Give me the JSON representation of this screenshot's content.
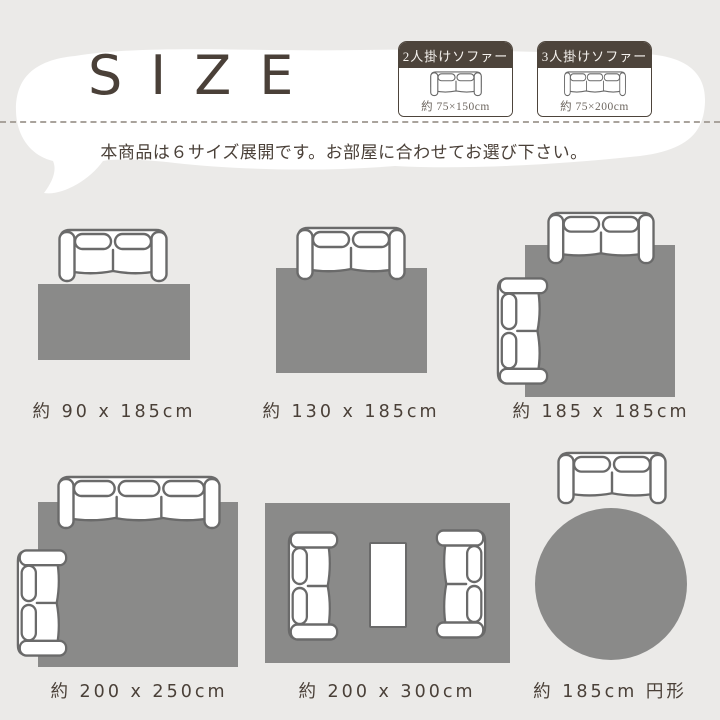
{
  "colors": {
    "background": "#ebeae8",
    "bubble": "#ffffff",
    "text_dark": "#4a4038",
    "rug_gray": "#8a8a89",
    "header_brown": "#4d443b",
    "legend_size_text": "#6d665f",
    "sofa_outline": "#6a6a6a",
    "dash": "#a9a39c"
  },
  "header": {
    "title": "SIZE",
    "subtitle": "本商品は６サイズ展開です。お部屋に合わせてお選び下さい。"
  },
  "legend": {
    "items": [
      {
        "label": "2人掛けソファー",
        "size": "約 75×150cm",
        "icon": "sofa-2seat-top-view"
      },
      {
        "label": "3人掛けソファー",
        "size": "約 75×200cm",
        "icon": "sofa-3seat-top-view"
      }
    ]
  },
  "layouts": [
    {
      "label": "約 90 x 185cm",
      "shape": "rectangle",
      "furniture": [
        "sofa-2seat-above-rug"
      ]
    },
    {
      "label": "約 130 x 185cm",
      "shape": "rectangle",
      "furniture": [
        "sofa-2seat-on-top-edge"
      ]
    },
    {
      "label": "約 185 x 185cm",
      "shape": "square",
      "furniture": [
        "sofa-2seat-on-top-edge",
        "sofa-2seat-on-left-edge"
      ]
    },
    {
      "label": "約 200 x 250cm",
      "shape": "rectangle",
      "furniture": [
        "sofa-3seat-on-top-edge",
        "sofa-2seat-on-left-edge"
      ]
    },
    {
      "label": "約 200 x 300cm",
      "shape": "rectangle",
      "furniture": [
        "sofa-2seat-facing-right",
        "table",
        "sofa-2seat-facing-left"
      ]
    },
    {
      "label": "約 185cm 円形",
      "shape": "circle",
      "furniture": [
        "sofa-2seat-above-rug"
      ]
    }
  ]
}
